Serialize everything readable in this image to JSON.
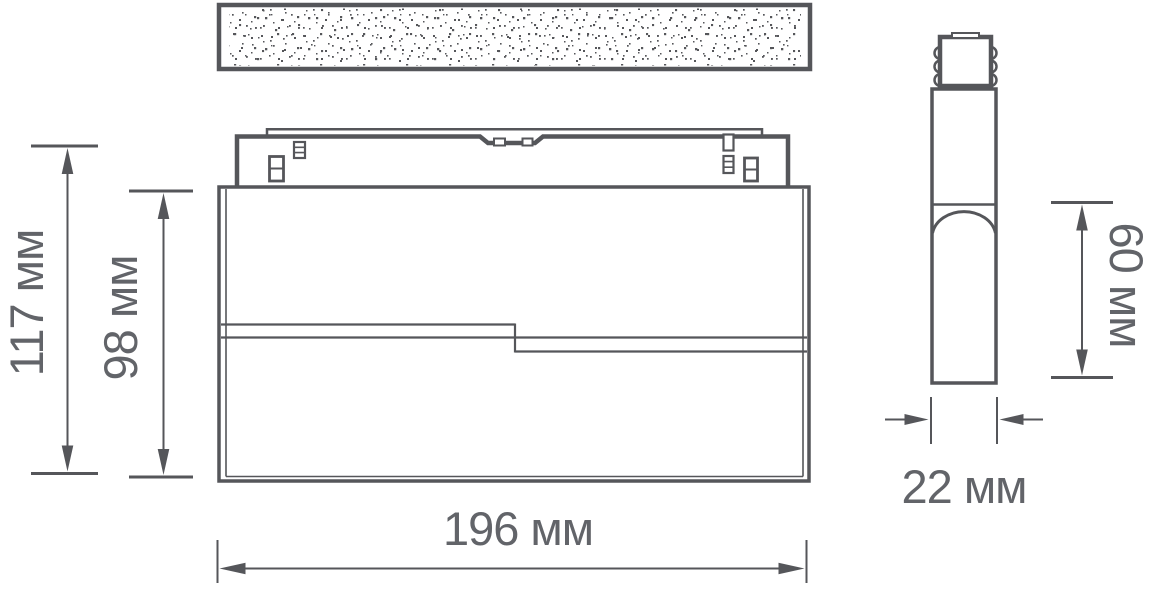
{
  "diagram": {
    "type": "product-dimension-drawing",
    "views": {
      "front": "track light fixture front view with mounting adapter and ceiling track",
      "side": "track light fixture side profile with connector"
    },
    "labels": {
      "total_height": "117 мм",
      "body_height": "98 мм",
      "width": "196 мм",
      "depth": "22 мм",
      "lens_height": "60 мм"
    },
    "colors": {
      "line": "#55565a",
      "text": "#626469",
      "background": "#ffffff"
    }
  }
}
